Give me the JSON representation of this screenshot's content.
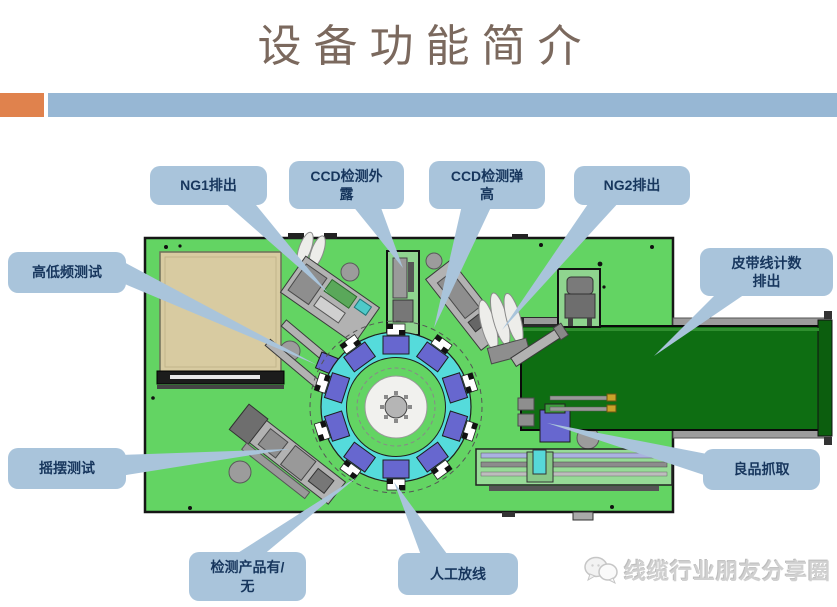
{
  "slide": {
    "title": "设备功能简介"
  },
  "callouts": [
    {
      "id": "ng1",
      "label": "NG1排出"
    },
    {
      "id": "ccd-exposure",
      "label": "CCD检测外\n露"
    },
    {
      "id": "ccd-spring",
      "label": "CCD检测弹\n高"
    },
    {
      "id": "ng2",
      "label": "NG2排出"
    },
    {
      "id": "hi-lo-test",
      "label": "高低频测试"
    },
    {
      "id": "belt-count",
      "label": "皮带线计数\n排出"
    },
    {
      "id": "swing-test",
      "label": "摇摆测试"
    },
    {
      "id": "good-pick",
      "label": "良品抓取"
    },
    {
      "id": "detect-presence",
      "label": "检测产品有/\n无"
    },
    {
      "id": "manual-feed",
      "label": "人工放线"
    }
  ],
  "watermark": {
    "text": "线缆行业朋友分享圈",
    "icon": "chat-bubbles-icon"
  },
  "colors": {
    "title_color": "#7b695e",
    "accent_orange": "#e0824d",
    "accent_blue": "#97b7d4",
    "callout_fill": "#a9c4db",
    "callout_text": "#17365d",
    "machine_green": "#63d463",
    "belt_green": "#0e6e12",
    "ring_cyan": "#55dbdb",
    "station_purple": "#6767cf",
    "tray_tan": "#d8cba1"
  }
}
